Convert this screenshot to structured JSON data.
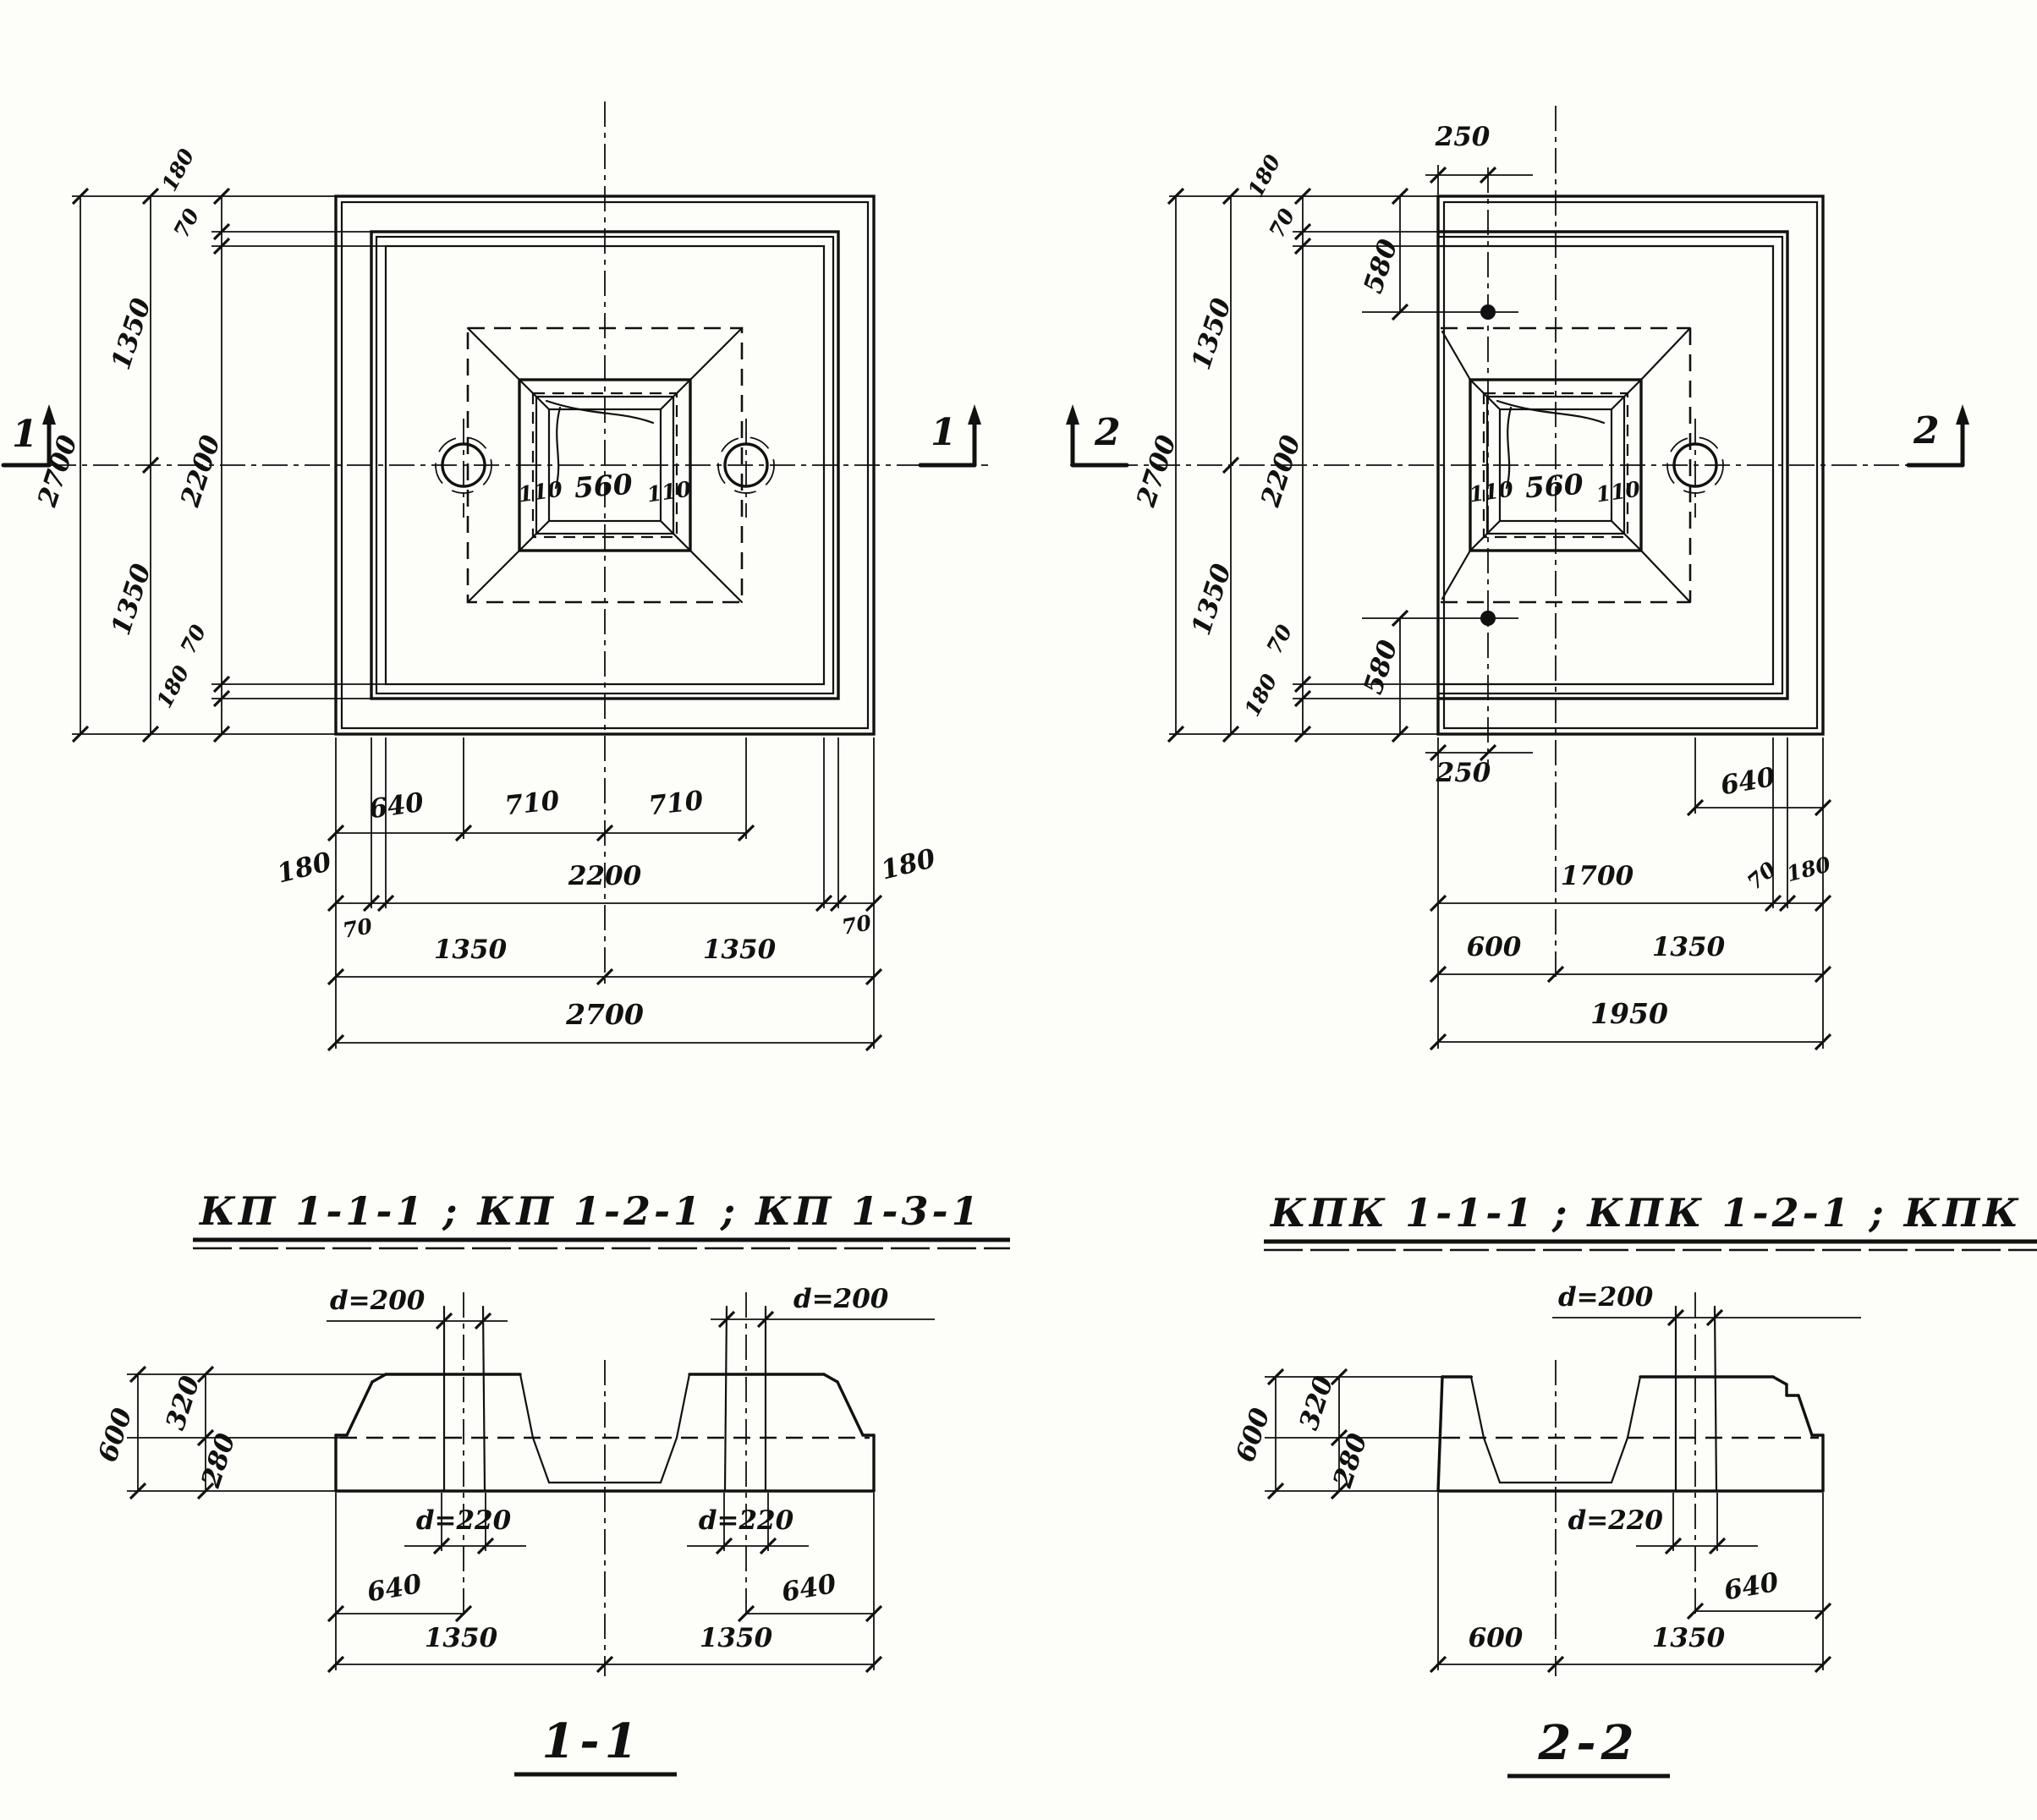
{
  "plan_left": {
    "title": "КП 1-1-1 ; КП 1-2-1 ; КП 1-3-1",
    "marker": "1",
    "v2700": "2700",
    "v1350t": "1350",
    "v1350b": "1350",
    "v2200": "2200",
    "v180t": "180",
    "v70t": "70",
    "v70b": "70",
    "v180b": "180",
    "b640": "640",
    "b710l": "710",
    "b710r": "710",
    "b180l": "180",
    "b2200": "2200",
    "b180r": "180",
    "b70l": "70",
    "b70r": "70",
    "b1350l": "1350",
    "b1350r": "1350",
    "b2700": "2700",
    "s110l": "110",
    "s560": "560",
    "s110r": "110"
  },
  "plan_right": {
    "title": "КПК 1-1-1 ; КПК 1-2-1 ; КПК 1-3-1",
    "marker": "2",
    "t250": "250",
    "b250": "250",
    "v580t": "580",
    "v580b": "580",
    "v2700": "2700",
    "v1350t": "1350",
    "v1350b": "1350",
    "v2200": "2200",
    "v180t": "180",
    "v70t": "70",
    "v70b": "70",
    "v180b": "180",
    "r640": "640",
    "b1700": "1700",
    "b70": "70",
    "b180": "180",
    "b600": "600",
    "b1350": "1350",
    "b1950": "1950",
    "s110l": "110",
    "s560": "560",
    "s110r": "110"
  },
  "section_1_1": {
    "label": "1-1",
    "d200l": "d=200",
    "d200r": "d=200",
    "d220l": "d=220",
    "d220r": "d=220",
    "v600": "600",
    "v320": "320",
    "v280": "280",
    "b640l": "640",
    "b640r": "640",
    "b1350l": "1350",
    "b1350r": "1350"
  },
  "section_2_2": {
    "label": "2-2",
    "d200": "d=200",
    "d220": "d=220",
    "v600": "600",
    "v320": "320",
    "v280": "280",
    "b640": "640",
    "b600": "600",
    "b1350": "1350"
  }
}
